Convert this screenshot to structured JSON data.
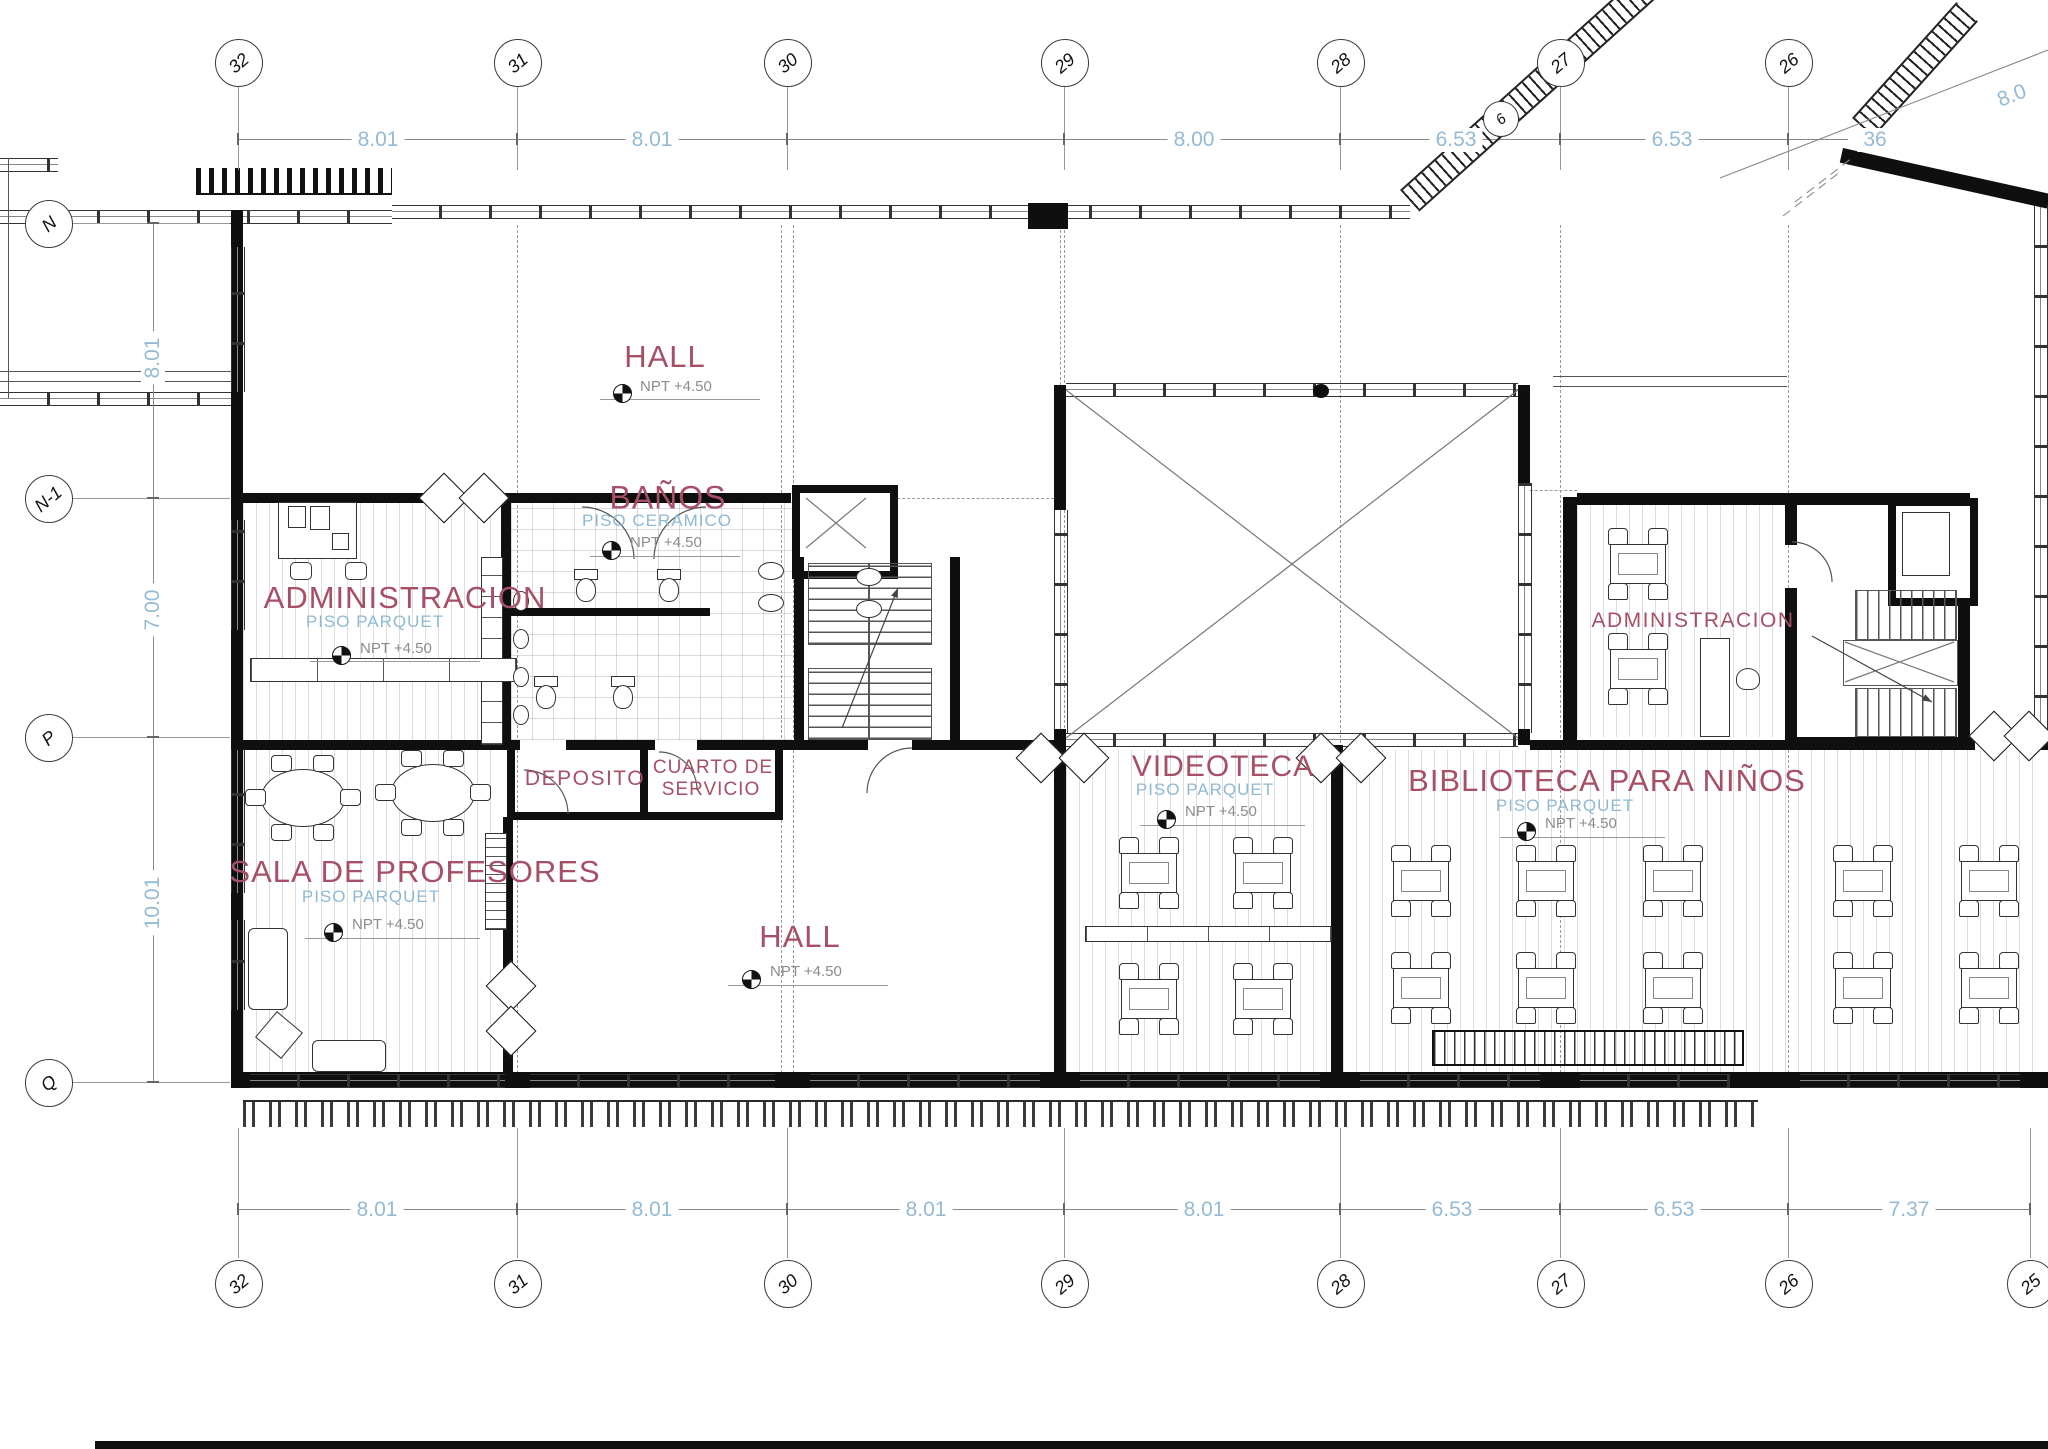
{
  "colors": {
    "room_label": "#a64f66",
    "floor_label": "#8fb9d3",
    "dimension": "#95bad3",
    "wall": "#0f0f0f"
  },
  "grid": {
    "columns_top": [
      {
        "id": "32",
        "x": 238
      },
      {
        "id": "31",
        "x": 517
      },
      {
        "id": "30",
        "x": 787
      },
      {
        "id": "29",
        "x": 1064
      },
      {
        "id": "28",
        "x": 1340
      },
      {
        "id": "27",
        "x": 1560
      },
      {
        "id": "26",
        "x": 1788
      }
    ],
    "column_aux": {
      "id": "6",
      "x": 1500,
      "y": 118
    },
    "columns_bottom": [
      {
        "id": "32",
        "x": 238
      },
      {
        "id": "31",
        "x": 517
      },
      {
        "id": "30",
        "x": 787
      },
      {
        "id": "29",
        "x": 1064
      },
      {
        "id": "28",
        "x": 1340
      },
      {
        "id": "27",
        "x": 1560
      },
      {
        "id": "26",
        "x": 1788
      },
      {
        "id": "25",
        "x": 2030
      }
    ],
    "rows": [
      {
        "id": "N",
        "y": 223
      },
      {
        "id": "N-1",
        "y": 498
      },
      {
        "id": "P",
        "y": 737
      },
      {
        "id": "Q",
        "y": 1082
      }
    ],
    "dims_top": [
      {
        "v": "8.01",
        "x": 378
      },
      {
        "v": "8.01",
        "x": 652
      },
      {
        "v": "8.00",
        "x": 1194
      },
      {
        "v": "6.53",
        "x": 1456
      },
      {
        "v": "6.53",
        "x": 1672
      },
      {
        "v": "36",
        "x": 1875
      }
    ],
    "dim_diagonal": {
      "v": "8.0",
      "x": 2012,
      "y": 96
    },
    "dims_bottom": [
      {
        "v": "8.01",
        "x": 377
      },
      {
        "v": "8.01",
        "x": 652
      },
      {
        "v": "8.01",
        "x": 926
      },
      {
        "v": "8.01",
        "x": 1204
      },
      {
        "v": "6.53",
        "x": 1452
      },
      {
        "v": "6.53",
        "x": 1674
      },
      {
        "v": "7.37",
        "x": 1909
      }
    ],
    "dims_left": [
      {
        "v": "8.01",
        "y": 358
      },
      {
        "v": "7.00",
        "y": 610
      },
      {
        "v": "10.01",
        "y": 903
      }
    ]
  },
  "rooms": {
    "hall_top": {
      "name": "HALL",
      "npt": "NPT +4.50"
    },
    "banos": {
      "name": "BAÑOS",
      "floor": "PISO CERAMICO",
      "npt": "NPT +4.50"
    },
    "admin_left": {
      "name": "ADMINISTRACION",
      "floor": "PISO PARQUET",
      "npt": "NPT +4.50"
    },
    "sala": {
      "name": "SALA DE PROFESORES",
      "floor": "PISO PARQUET",
      "npt": "NPT +4.50"
    },
    "deposito": {
      "name": "DEPOSITO"
    },
    "cuarto_servicio": {
      "name": "CUARTO DE",
      "name2": "SERVICIO"
    },
    "hall_bottom": {
      "name": "HALL",
      "npt": "NPT +4.50"
    },
    "videoteca": {
      "name": "VIDEOTECA",
      "floor": "PISO PARQUET",
      "npt": "NPT +4.50"
    },
    "biblioteca": {
      "name": "BIBLIOTECA PARA NIÑOS",
      "floor": "PISO PARQUET",
      "npt": "NPT +4.50"
    },
    "admin_right": {
      "name": "ADMINISTRACION"
    }
  },
  "furniture": {
    "tables_four": [
      [
        1148,
        872
      ],
      [
        1262,
        872
      ],
      [
        1148,
        998
      ],
      [
        1262,
        998
      ],
      [
        1420,
        880
      ],
      [
        1545,
        880
      ],
      [
        1672,
        880
      ],
      [
        1862,
        880
      ],
      [
        1988,
        880
      ],
      [
        1420,
        987
      ],
      [
        1545,
        987
      ],
      [
        1672,
        987
      ],
      [
        1862,
        987
      ],
      [
        1988,
        987
      ],
      [
        1637,
        563
      ],
      [
        1637,
        668
      ]
    ],
    "tables_oval": [
      [
        302,
        797
      ],
      [
        432,
        792
      ]
    ],
    "diamonds": [
      [
        443,
        497
      ],
      [
        483,
        497
      ],
      [
        510,
        985
      ],
      [
        510,
        1030
      ],
      [
        1040,
        757
      ],
      [
        1083,
        757
      ],
      [
        1320,
        757
      ],
      [
        1360,
        757
      ],
      [
        1993,
        735
      ],
      [
        2028,
        735
      ]
    ],
    "urinals": [
      [
        520,
        600
      ],
      [
        520,
        638
      ],
      [
        520,
        676
      ],
      [
        520,
        714
      ]
    ],
    "toilets": [
      [
        585,
        583
      ],
      [
        668,
        583
      ],
      [
        545,
        690
      ],
      [
        622,
        690
      ]
    ],
    "sinks": [
      [
        770,
        570
      ],
      [
        770,
        602
      ],
      [
        868,
        576
      ],
      [
        868,
        608
      ]
    ]
  }
}
